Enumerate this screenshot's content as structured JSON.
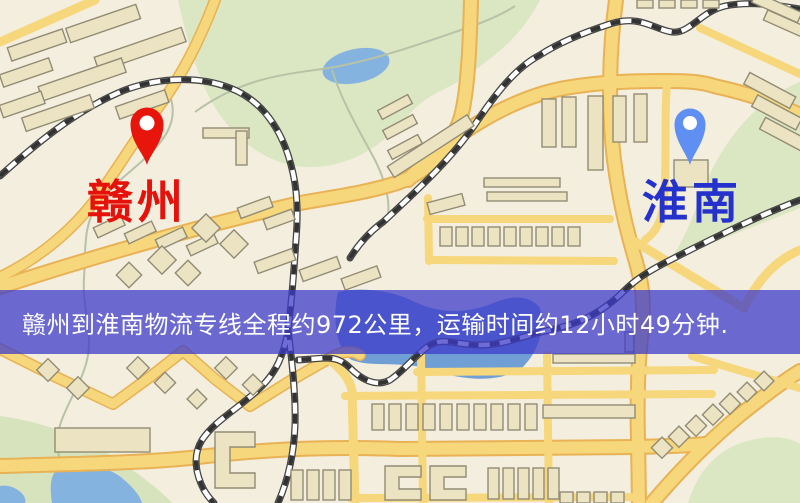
{
  "map": {
    "origin": {
      "name": "赣州",
      "icon": "red-location-pin-icon"
    },
    "destination": {
      "name": "淮南",
      "icon": "blue-location-pin-icon"
    }
  },
  "banner": {
    "text": "赣州到淮南物流专线全程约972公里，运输时间约12小时49分钟."
  },
  "colors": {
    "map-bg": "#f3eedd",
    "park-green": "#dbe7c3",
    "park-green-2": "#d6e3bd",
    "water-blue": "#84b3e0",
    "water-deep": "#6f9fd4",
    "road-yellow": "#f7d77b",
    "road-casing": "#e8b255",
    "railway-dark": "#333333",
    "building-fill": "#ebe3c2",
    "building-stroke": "#928c75",
    "path-grey": "#b7c2a7",
    "pin-red": "#e8150c",
    "pin-blue": "#5f8ff2",
    "label-red": "#e6110a",
    "label-blue": "#2531cc",
    "banner-bg": "rgba(60,58,202,0.74)",
    "banner-text": "#ffffff"
  }
}
